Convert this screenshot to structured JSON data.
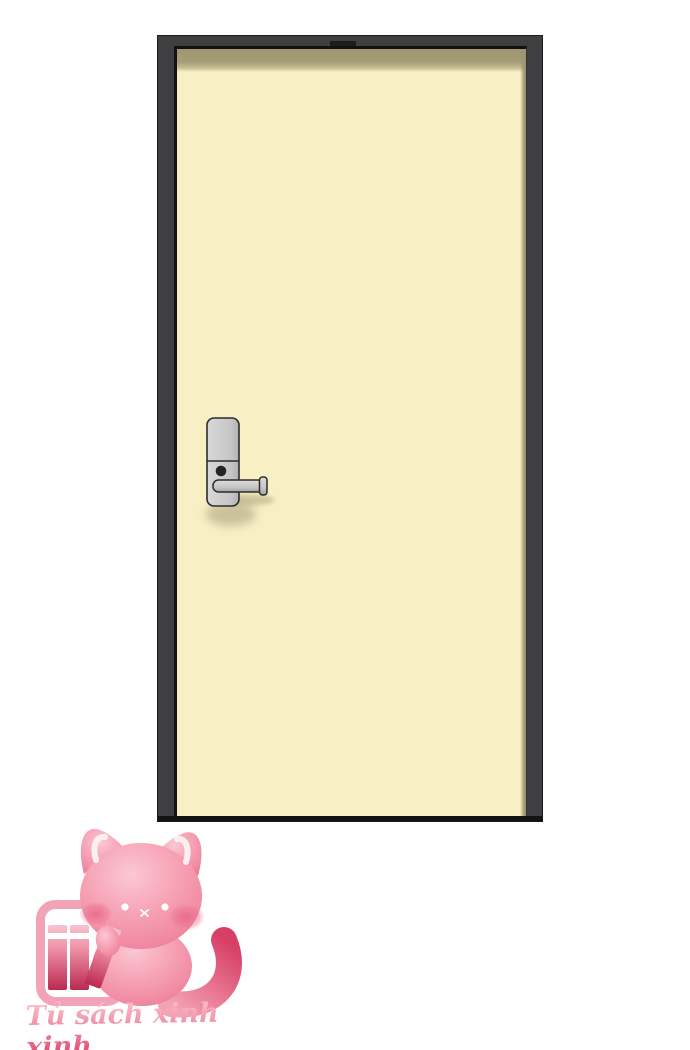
{
  "page": {
    "background_color": "#ffffff"
  },
  "scene": {
    "description": "Closed cream door in a dark frame with an electronic lock and lever handle",
    "door": {
      "frame_color": "#3f3f41",
      "edge_line_color": "#121212",
      "panel_color": "#f9efc5",
      "top_shadow_color": "#a29a72",
      "side_shadow_color": "#9d9574"
    },
    "lock": {
      "body_color": "#cdcdcd",
      "outline_color": "#2c2c2c",
      "keyhole_color": "#242424",
      "handle_color": "#c9c9c9",
      "shadow_color": "#9c9370"
    }
  },
  "watermark": {
    "text": "Tủ sách xinh xinh",
    "text_color_top": "#f9b7c4",
    "text_color_bottom": "#d93c63",
    "mascot": {
      "name": "pink-cat-with-bookshelf",
      "cat_color_light": "#fbc8d3",
      "cat_color_dark": "#ea7390",
      "ear_highlight_color": "#fdeef2",
      "book_color_light": "#f8c3cf",
      "book_color_dark": "#bb2950",
      "shelf_color": "#f2a3b7",
      "tail_tip_color": "#d74066"
    }
  }
}
